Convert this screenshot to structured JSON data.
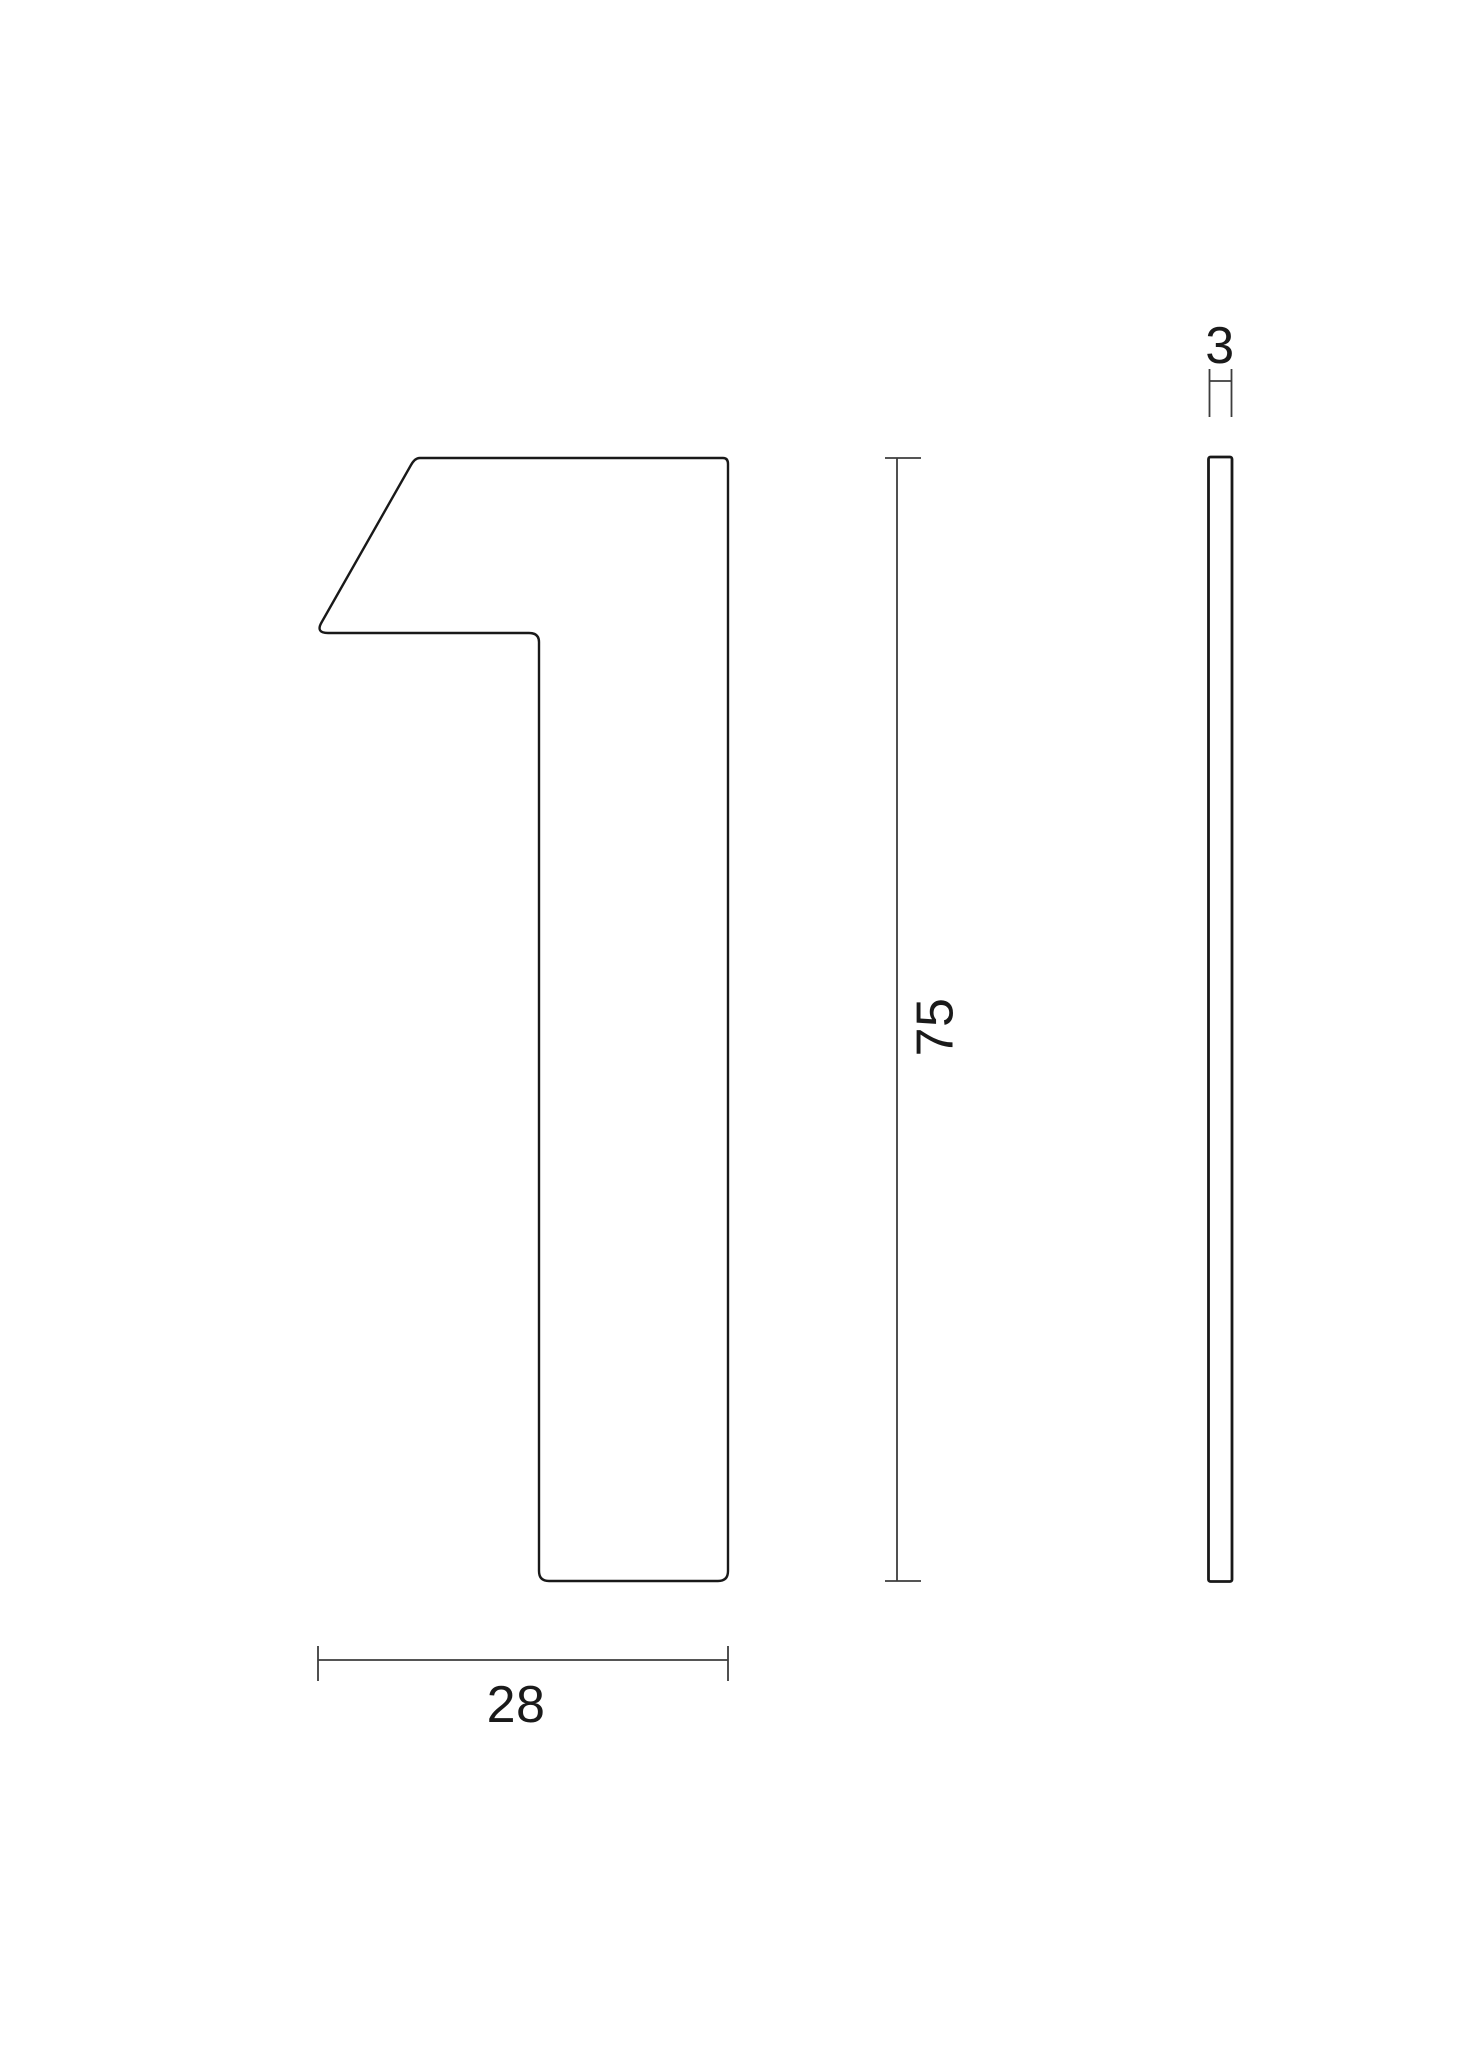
{
  "figure": {
    "name": "technical-drawing-house-number-1",
    "views": {
      "front": {
        "shape": "numeral-1"
      },
      "side": {
        "shape": "thin-plate"
      }
    },
    "dimensions": {
      "height": {
        "label": "75"
      },
      "width": {
        "label": "28"
      },
      "thickness": {
        "label": "3"
      }
    },
    "colors": {
      "background": "#ffffff",
      "outline": "#191919",
      "dimension_line": "#3d3d3d",
      "label_text": "#1a1a1a"
    }
  }
}
